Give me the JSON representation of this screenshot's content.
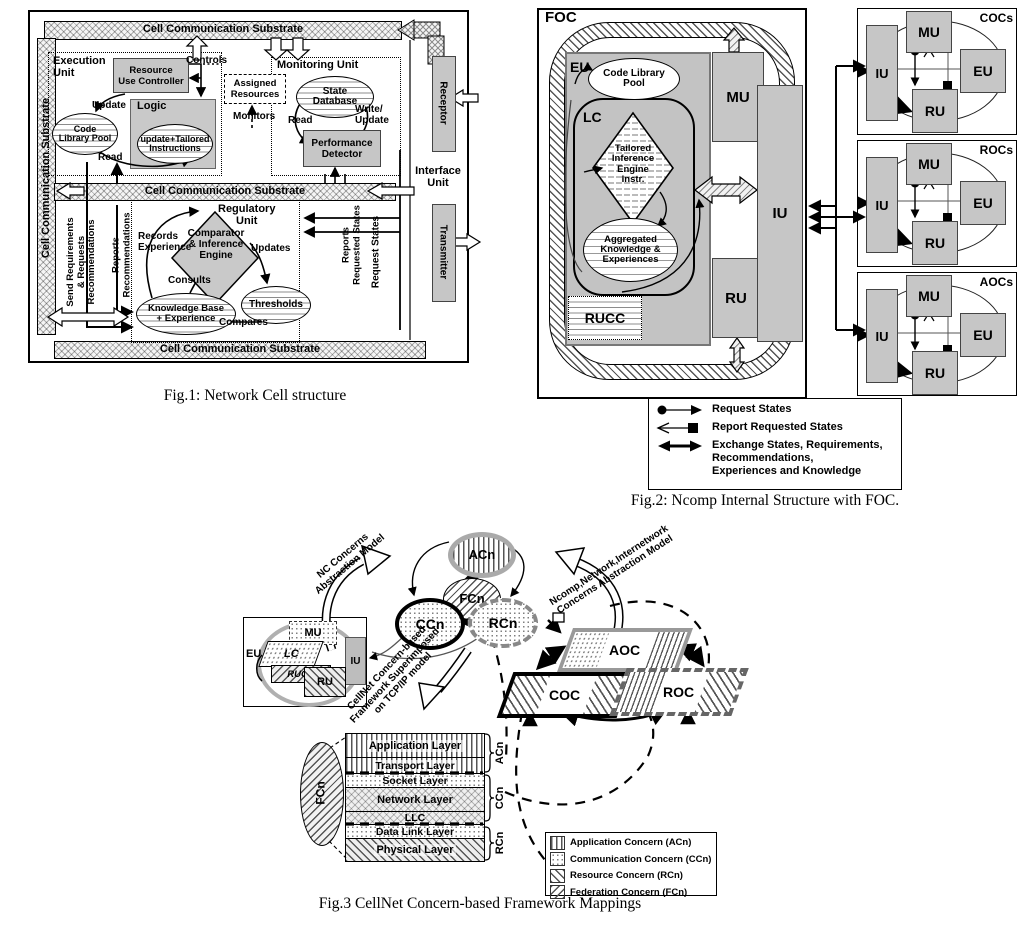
{
  "colors": {
    "block_gray": "#c6c6c6",
    "line_black": "#000000"
  },
  "fig1": {
    "caption": "Fig.1: Network Cell structure",
    "substrate": "Cell Communication Substrate",
    "execution": {
      "title": "Execution\nUnit",
      "ruc": "Resource\nUse Controller",
      "controls": "Controls",
      "assigned": "Assigned\nResources",
      "monitors": "Monitors",
      "update": "Update",
      "logic": "Logic",
      "clp": "Code\nLibrary Pool",
      "instr": "update+Tailored\nInstructions",
      "read": "Read"
    },
    "monitoring": {
      "title": "Monitoring Unit",
      "state_db": "State\nDatabase",
      "read": "Read",
      "write": "Write/\nUpdate",
      "perf": "Performance\nDetector"
    },
    "regulatory": {
      "title": "Regulatory\nUnit",
      "records": "Records\nExperience",
      "engine": "Comparator\n& Inference\nEngine",
      "updates": "Updates",
      "consults": "Consults",
      "kb": "Knowledge Base\n+ Experience",
      "thresholds": "Thresholds",
      "compares": "Compares"
    },
    "interface_unit": "Interface\nUnit",
    "receptor": "Receptor",
    "transmitter": "Transmitter",
    "send_req": "Send Requirements\n& Requests\nRecommendations",
    "reports_rec": "Reports\nRecommendations",
    "reports_req_states": "Reports\nRequested States",
    "request_states": "Request States"
  },
  "fig2": {
    "caption": "Fig.2: Ncomp Internal Structure with FOC.",
    "foc": "FOC",
    "eu": "EU",
    "lc": "LC",
    "clp": "Code Library\nPool",
    "tie": "Tailored\nInference\nEngine\nInstr.",
    "ake": "Aggregated\nKnowledge &\nExperiences",
    "rucc": "RUCC",
    "mu": "MU",
    "ru": "RU",
    "iu": "IU",
    "group_labels": [
      "COCs",
      "ROCs",
      "AOCs"
    ],
    "legend": {
      "request": "Request States",
      "report": "Report Requested States",
      "exchange": "Exchange States, Requirements,\nRecommendations,\nExperiences and Knowledge"
    }
  },
  "fig3": {
    "caption": "Fig.3 CellNet Concern-based Framework Mappings",
    "nc_label": "NC Concerns\nAbstraction Model",
    "ncomp_label": "Ncomp,Network,Internetwork\nConcerns Abstraction Model",
    "cellnet_label": "CellNet Concern-based\nFramework Superimposed\non TCP/IP model",
    "acn": "ACn",
    "fcn": "FCn",
    "ccn": "CCn",
    "rcn": "RCn",
    "cell": {
      "mu": "MU",
      "eu": "EU",
      "lc": "LC",
      "rucc": "RUCC",
      "ru": "RU",
      "iu": "IU"
    },
    "aoc": "AOC",
    "coc": "COC",
    "roc": "ROC",
    "layers": [
      "Application Layer",
      "Transport Layer",
      "Socket Layer",
      "Network Layer",
      "LLC",
      "Data Link Layer",
      "Physical Layer"
    ],
    "stack_fcn": "FCn",
    "braces": [
      "ACn",
      "CCn",
      "RCn"
    ],
    "legend": [
      "Application Concern (ACn)",
      "Communication Concern (CCn)",
      "Resource Concern (RCn)",
      "Federation Concern (FCn)"
    ]
  }
}
